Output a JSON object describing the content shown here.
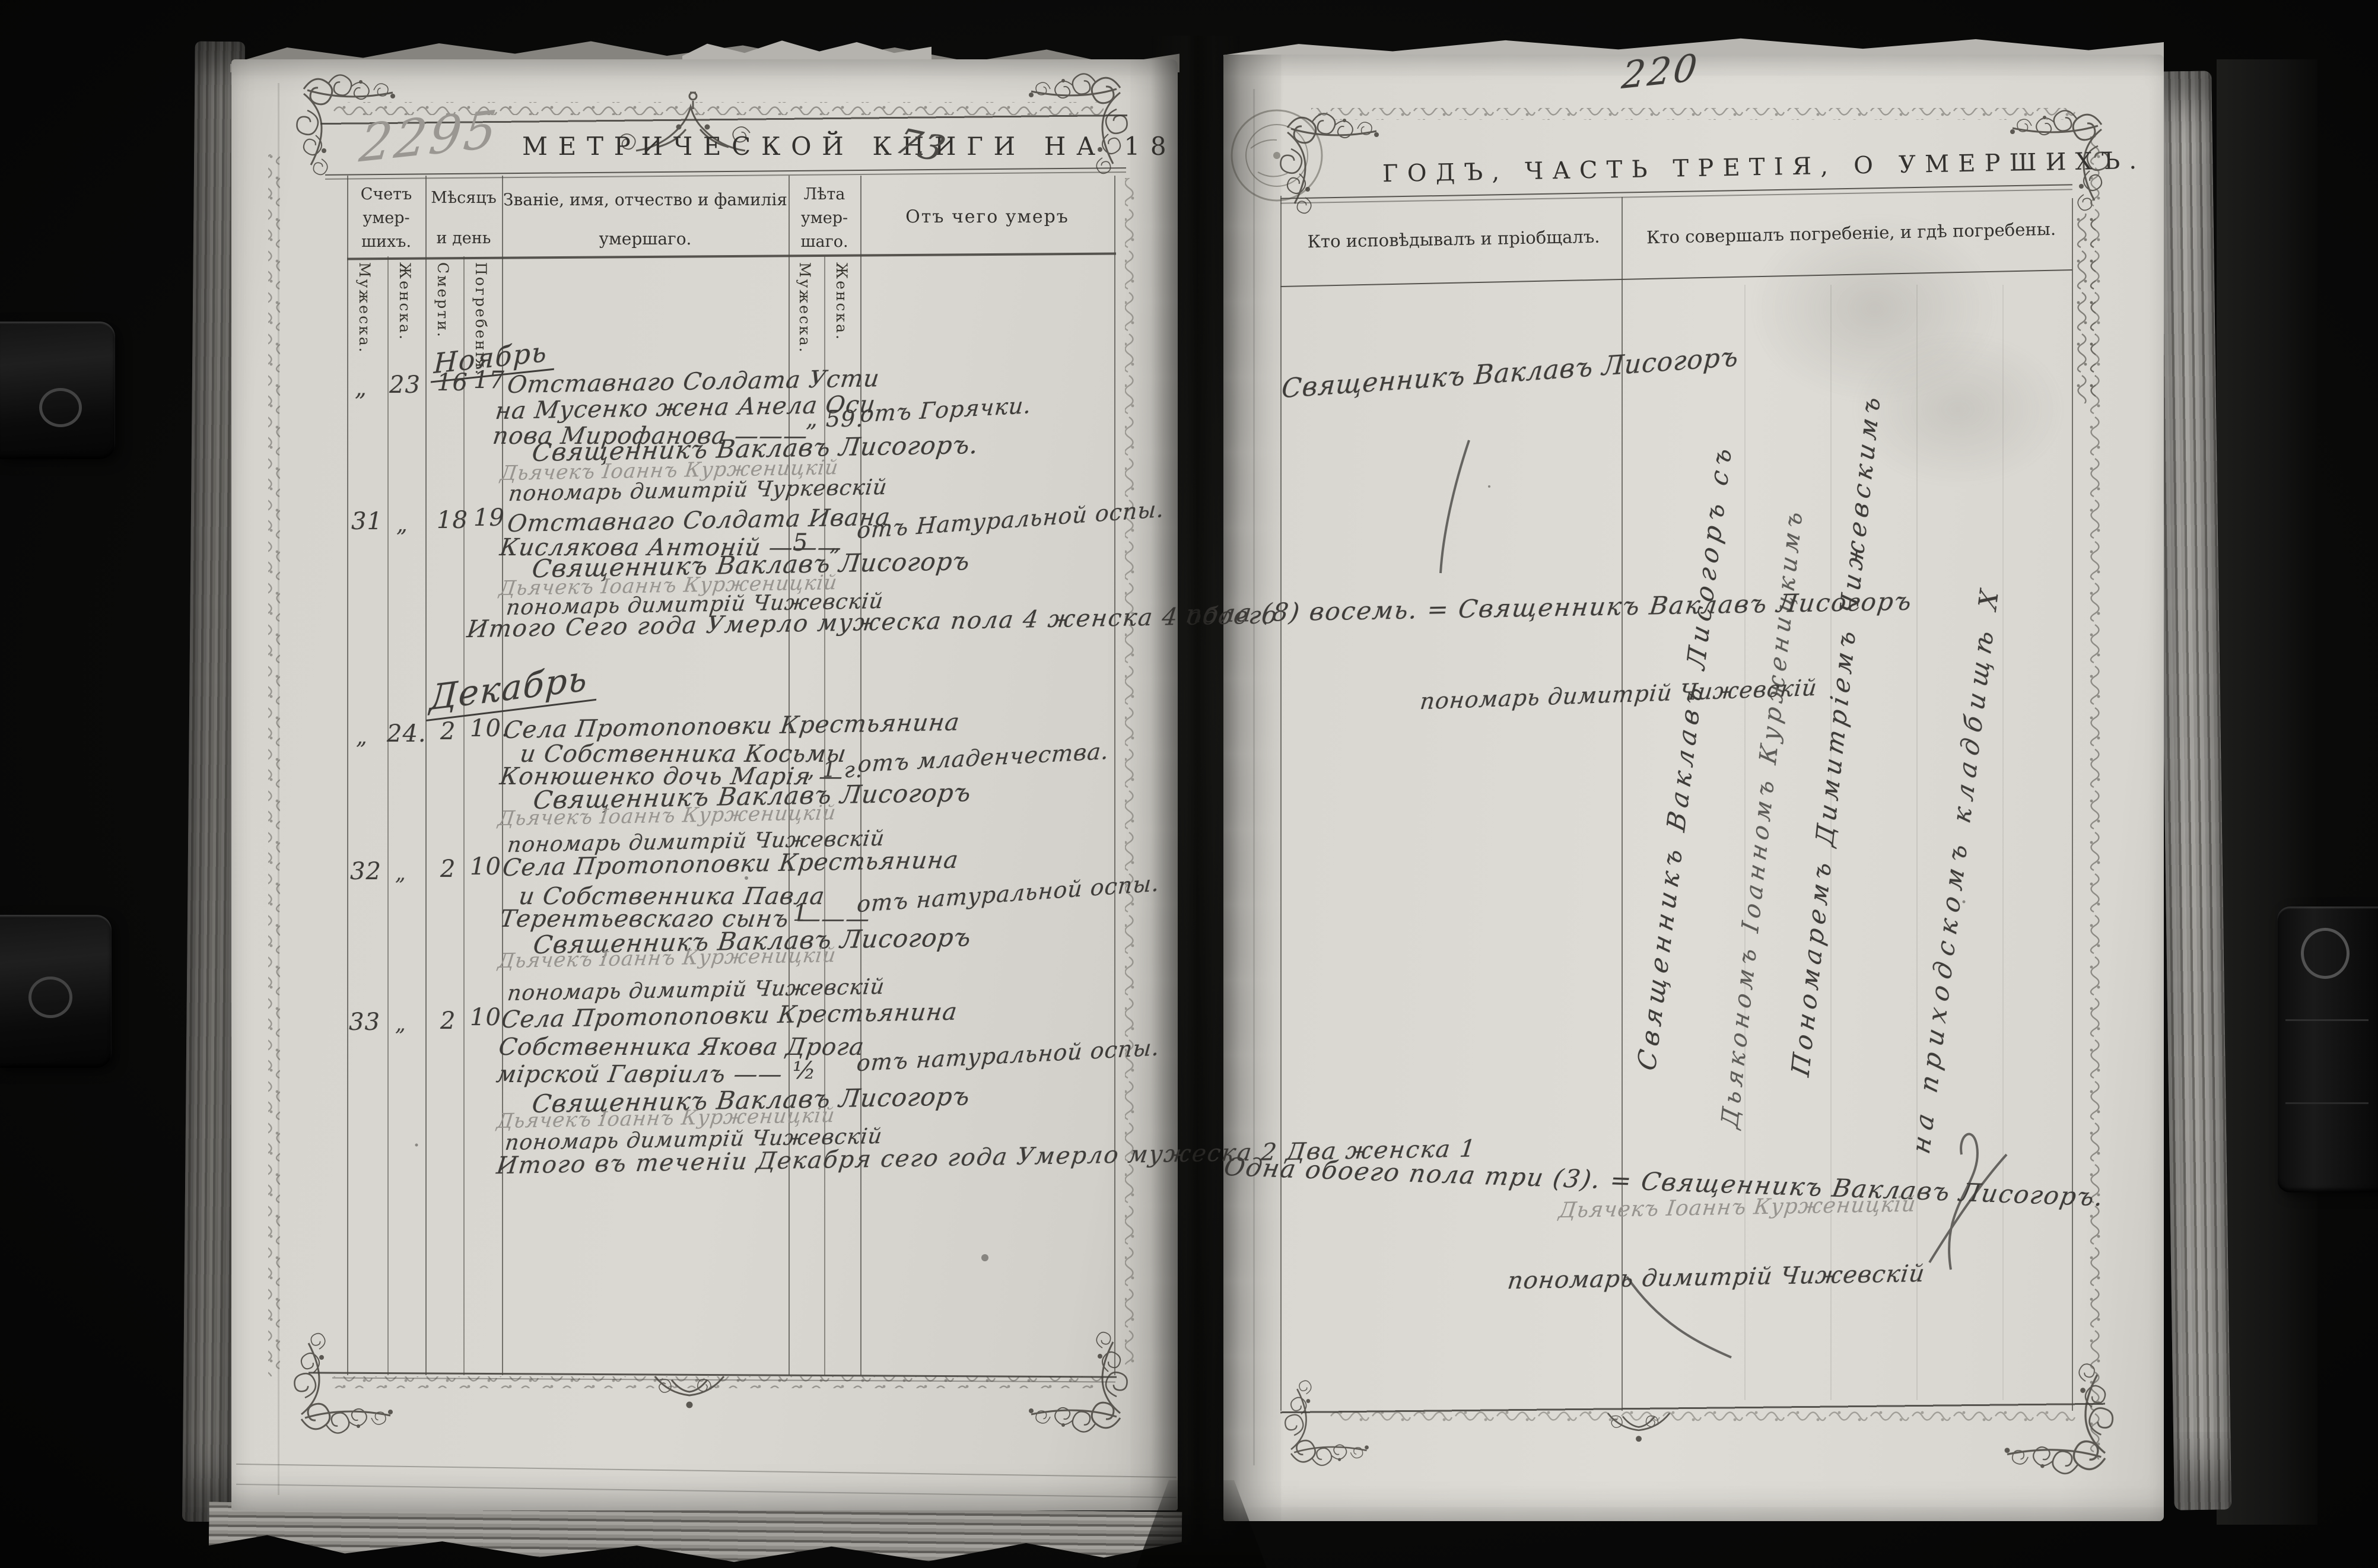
{
  "palette": {
    "ink_print": "#33312e",
    "ink_hand": "#3e3c39",
    "ink_pencil": "#97948f",
    "paper": "#d9d7d1",
    "background": "#0b0b0a"
  },
  "left_page": {
    "archive_number": "2295",
    "title": "МЕТРИЧЕСКОЙ КНИГИ НА 18",
    "title_year": "73",
    "header": {
      "count_l1": "Счетъ",
      "count_l2": "умер-",
      "count_l3": "шихъ.",
      "count_male": "Мужеска.",
      "count_female": "Женска.",
      "month_l1": "Мѣсяцъ",
      "month_l2": "и день",
      "month_death": "Смерти.",
      "month_burial": "Погребенія.",
      "name_l1": "Званіе, имя, отчество и фамилія",
      "name_l2": "умершаго.",
      "age_l1": "Лѣта",
      "age_l2": "умер-",
      "age_l3": "шаго.",
      "age_male": "Мужеска.",
      "age_female": "Женска.",
      "cause": "Отъ чего умеръ"
    },
    "month_november": "Ноябрь",
    "month_december": "Декабрь",
    "entries": [
      {
        "num_male": "„",
        "num_female": "23",
        "death_day": "16",
        "burial_day": "17",
        "line1": "Отставнаго Солдата Усти",
        "line2": "на Мусенко жена Анела Оси",
        "line3": "пова Мирофанова ———",
        "age_female": "„ 59.",
        "cause": "отъ Горячки.",
        "priest": "Священникъ Ваклавъ Лисогоръ.",
        "deacon": "Дьячекъ Іоаннъ Курженицкій",
        "sexton": "пономарь димитрій Чуркевскій"
      },
      {
        "num_male": "31",
        "num_female": "„",
        "death_day": "18",
        "burial_day": "19",
        "line1": "Отставнаго Солдата Ивана",
        "line2": "Кислякова Антоній ———",
        "age_male": "5",
        "age_female": "„",
        "cause": "отъ Натуральной оспы.",
        "priest": "Священникъ Ваклавъ Лисогоръ",
        "deacon": "Дьячекъ Іоаннъ Курженицкій",
        "sexton": "пономарь димитрій Чижевскій"
      },
      {
        "num_male": "„",
        "num_female": "24.",
        "death_day": "2",
        "burial_day": "10.",
        "line1": "Села Протопоповки Крестьянина",
        "line2": "и Собственника Косьмы",
        "line3": "Конюшенко дочь Марія —",
        "age_female": "„ 1 г.",
        "cause": "отъ младенчества.",
        "priest": "Священникъ Ваклавъ Лисогоръ",
        "deacon": "Дьячекъ Іоаннъ Курженицкій",
        "sexton": "пономарь димитрій Чижевскій"
      },
      {
        "num_male": "32",
        "num_female": "„",
        "death_day": "2",
        "burial_day": "10",
        "line1": "Села Протопоповки Крестьянина",
        "line2": "и Собственника Павла",
        "line3": "Терентьевскаго сынъ ———",
        "age_male": "1",
        "cause": "отъ натуральной оспы.",
        "priest": "Священникъ Ваклавъ Лисогоръ",
        "deacon": "Дьячекъ Іоаннъ Курженицкій",
        "sexton": "пономарь димитрій Чижевскій"
      },
      {
        "num_male": "33",
        "num_female": "„",
        "death_day": "2",
        "burial_day": "10",
        "line1": "Села Протопоповки Крестьянина",
        "line2": "Собственника Якова Дрога",
        "line3": "мірской Гавріилъ ——",
        "age_male": "½",
        "cause": "отъ натуральной оспы.",
        "priest": "Священникъ Ваклавъ Лисогоръ",
        "deacon": "Дьячекъ Іоаннъ Курженицкій",
        "sexton": "пономарь димитрій Чижевскій"
      }
    ],
    "totals_november": "Итого Сего года Умерло мужеска пола 4 женска 4 обоего",
    "totals_december": "Итого въ теченіи Декабря сего года Умерло мужеска 2 Два женска 1"
  },
  "right_page": {
    "page_number": "220",
    "title": "ГОДЪ, ЧАСТЬ ТРЕТІЯ, О УМЕРШИХЪ.",
    "header": {
      "confessor": "Кто исповѣдывалъ и пріобщалъ.",
      "burier": "Кто совершалъ погребеніе, и гдѣ погребены."
    },
    "notes": {
      "row1_priest": "Священникъ Ваклавъ Лисогоръ",
      "nov_totals_cont": "пола (8) восемь. = Священникъ Ваклавъ Лисогоръ",
      "nov_sexton": "пономарь димитрій Чижевскій",
      "diag_priest": "Священникъ Ваклавъ Лисогоръ съ",
      "diag_deacon": "Дьякономъ Іоанномъ Курженицкимъ",
      "diag_sexton": "Пономаремъ Димитріемъ Чижевскимъ",
      "diag_place": "на приходскомъ кладбищѣ Х",
      "dec_totals_cont": "Одна обоего пола три (3). = Священникъ Ваклавъ Лисогоръ.",
      "dec_deacon": "Дьячекъ Іоаннъ Курженицкій",
      "dec_sexton": "пономарь димитрій Чижевскій"
    }
  }
}
